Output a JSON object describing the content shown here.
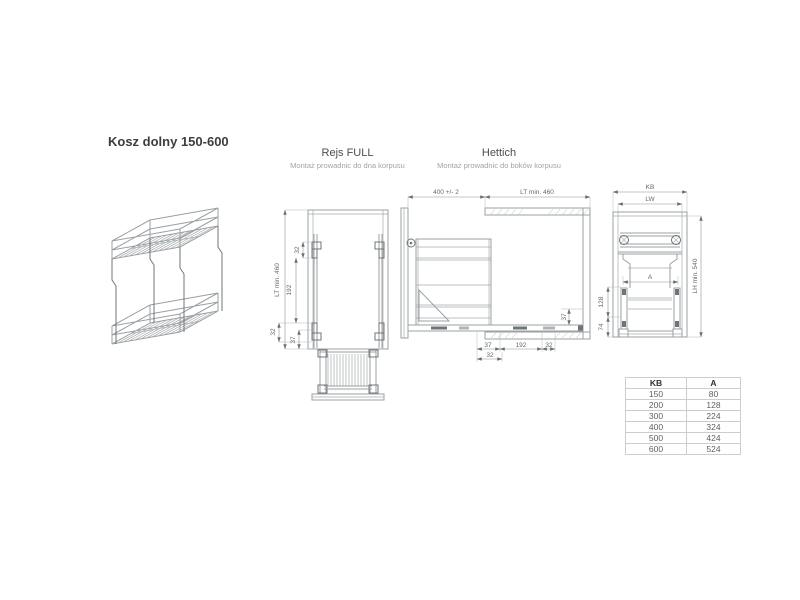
{
  "page": {
    "title": "Kosz dolny 150-600"
  },
  "sections": {
    "rejs_full": {
      "title": "Rejs FULL",
      "subtitle": "Montaż prowadnic do dna korpusu"
    },
    "hettich": {
      "title": "Hettich",
      "subtitle": "Montaż prowadnic do boków korpusu"
    }
  },
  "drawings": {
    "rejs_full_dims": {
      "lt": "LT min. 460",
      "top32": "32",
      "mid192": "192",
      "bottom32": "32",
      "bottom37": "37"
    },
    "hettich_dims": {
      "width": "400 +/- 2",
      "depth": "LT min. 460",
      "right37": "37",
      "row1_37": "37",
      "row1_192": "192",
      "row1_32": "32",
      "row2_32": "32"
    },
    "front_dims": {
      "kb": "KB",
      "lw": "LW",
      "lh": "LH min. 540",
      "a": "A",
      "d128": "128",
      "d74": "74"
    }
  },
  "size_table": {
    "headers": [
      "KB",
      "A"
    ],
    "rows": [
      [
        "150",
        "80"
      ],
      [
        "200",
        "128"
      ],
      [
        "300",
        "224"
      ],
      [
        "400",
        "324"
      ],
      [
        "500",
        "424"
      ],
      [
        "600",
        "524"
      ]
    ]
  },
  "colors": {
    "line": "#9ba0a3",
    "line_dark": "#707578",
    "dim_text": "#63686b",
    "title": "#3b3e40",
    "subtitle": "#a0a3a5",
    "table_border": "#cbced0"
  }
}
